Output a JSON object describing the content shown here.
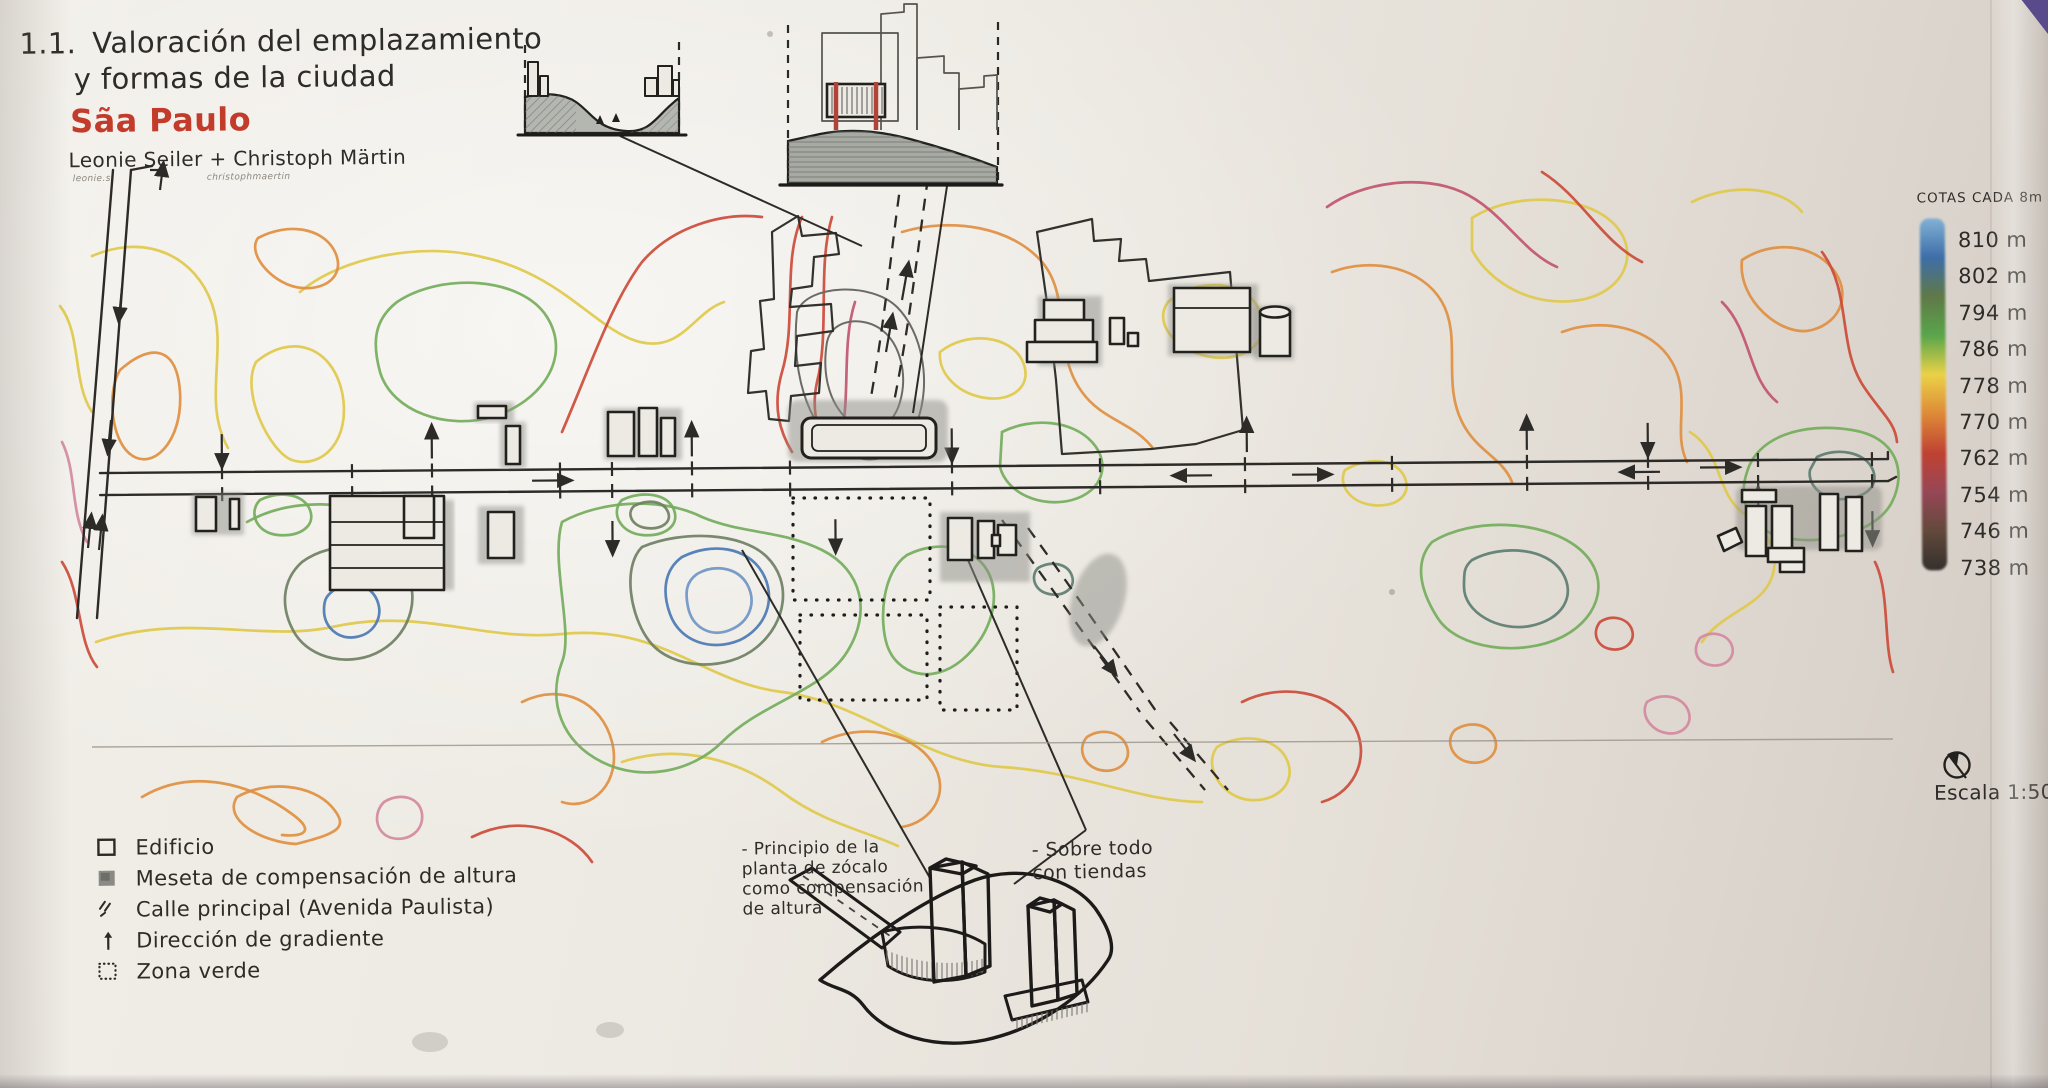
{
  "title": {
    "index": "1.1.",
    "line1": "Valoración del emplazamiento",
    "line2": "y formas de la ciudad",
    "city": "Sãa Paulo",
    "authors": "Leonie Seiler + Christoph Märtin",
    "signature_left": "leonie.s",
    "signature_right": "christophmaertin"
  },
  "elevation_scale": {
    "title": "COTAS CADA 8m",
    "entries": [
      {
        "label": "810 m",
        "color": "#7fb2d9"
      },
      {
        "label": "802 m",
        "color": "#3a6fae"
      },
      {
        "label": "794 m",
        "color": "#5e7a44"
      },
      {
        "label": "786 m",
        "color": "#55a845"
      },
      {
        "label": "778 m",
        "color": "#edd23c"
      },
      {
        "label": "770 m",
        "color": "#e4882f"
      },
      {
        "label": "762 m",
        "color": "#c8402f"
      },
      {
        "label": "754 m",
        "color": "#9c4556"
      },
      {
        "label": "746 m",
        "color": "#64493a"
      },
      {
        "label": "738 m",
        "color": "#33302c"
      }
    ]
  },
  "legend": {
    "items": [
      {
        "symbol": "building-outline",
        "label": "Edificio"
      },
      {
        "symbol": "shaded-square",
        "label": "Meseta de compensación de altura"
      },
      {
        "symbol": "hatch-marks",
        "label": "Calle principal (Avenida Paulista)"
      },
      {
        "symbol": "up-arrow",
        "label": "Dirección de gradiente"
      },
      {
        "symbol": "dotted-square",
        "label": "Zona verde"
      }
    ]
  },
  "annotations": {
    "zocalo": {
      "lines": [
        "- Principio de la",
        "planta de zócalo",
        "como compensación",
        "de altura"
      ]
    },
    "tiendas": {
      "lines": [
        "- Sobre todo",
        "con tiendas"
      ]
    }
  },
  "scale": {
    "label": "Escala 1:5000"
  }
}
